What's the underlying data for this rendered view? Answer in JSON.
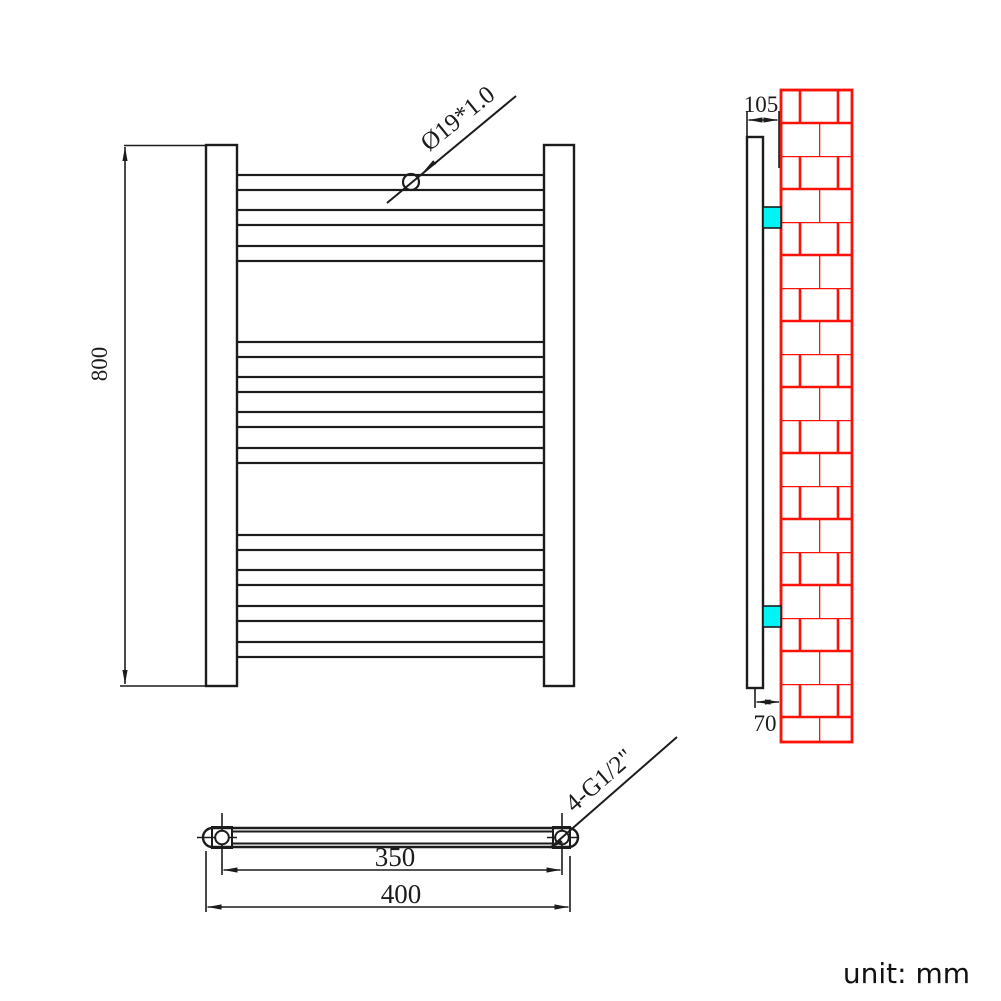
{
  "drawing": {
    "unit_note": "unit: mm",
    "dimensions": {
      "height": "800",
      "overall_width": "400",
      "tapping_centers": "350",
      "wall_to_front_top": "105",
      "wall_to_center_bottom": "70"
    },
    "labels": {
      "tube_spec": "Ø19*1.0",
      "thread_spec": "4-G1/2\""
    },
    "front_view": {
      "tube_count": 11,
      "tube_groups": [
        3,
        4,
        4
      ]
    },
    "side_view": {
      "bracket_count": 2
    },
    "colors": {
      "line": "#1c1c1c",
      "brick_red": "#f81208",
      "bracket_cyan": "#00f4f4",
      "background": "#ffffff"
    }
  }
}
